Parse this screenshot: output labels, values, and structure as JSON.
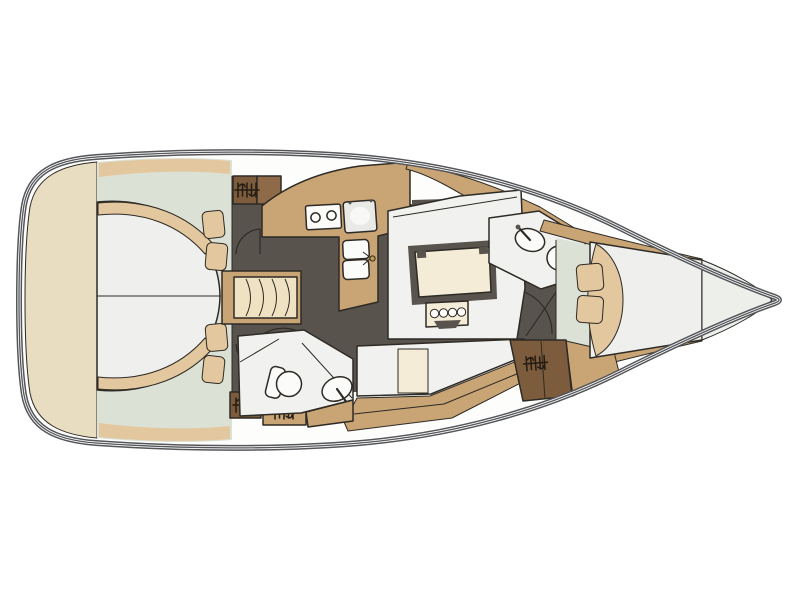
{
  "meta": {
    "title": "Sailing yacht interior layout plan",
    "view": "top-down deck plan",
    "orientation": "bow to the right, stern to the left"
  },
  "palette": {
    "white": "#fdfdfc",
    "hull_line": "#54565a",
    "outline": "#2e2a25",
    "deck": "#e9ddc1",
    "sage": "#dce1d6",
    "soft": "#e3c79e",
    "bed": "#eff0ed",
    "seat": "#f1f2ef",
    "cream": "#efe2c2",
    "table": "#f4ecd7",
    "wood": "#c9a474",
    "charcoal": "#59534e",
    "fixture": "#fbfbfa",
    "icebox": "#e9e9e7",
    "glow": "#f8f8f6",
    "locker_dark": "#7c5c3d",
    "locker_mid": "#8f6a49",
    "tip": "#edefeb",
    "brass": "#c09a4f"
  },
  "components": {
    "stern_deck": "Stern deck / transom",
    "aft_cabin_port": "Aft double berth (port)",
    "aft_cabin_starboard": "Aft double berth (starboard)",
    "hanging_lockers": "Hanging lockers with hanger symbol (x4)",
    "companionway": "Companionway steps",
    "galley": "L-shaped galley: 2-burner stove, icebox, double sink with faucet",
    "salon": "U-shaped settee with table and bottle rack",
    "starboard_settee": "Straight settee (starboard side)",
    "aft_head": "Aft head: toilet and washbasin",
    "forward_head": "Forward head: washbasin and toilet",
    "forward_cabin": "Forward V-berth with two pillows and folded blanket",
    "bow": "Bow stowage locker",
    "burner_count": 2,
    "galley_sink_count": 2,
    "head_count": 2
  }
}
